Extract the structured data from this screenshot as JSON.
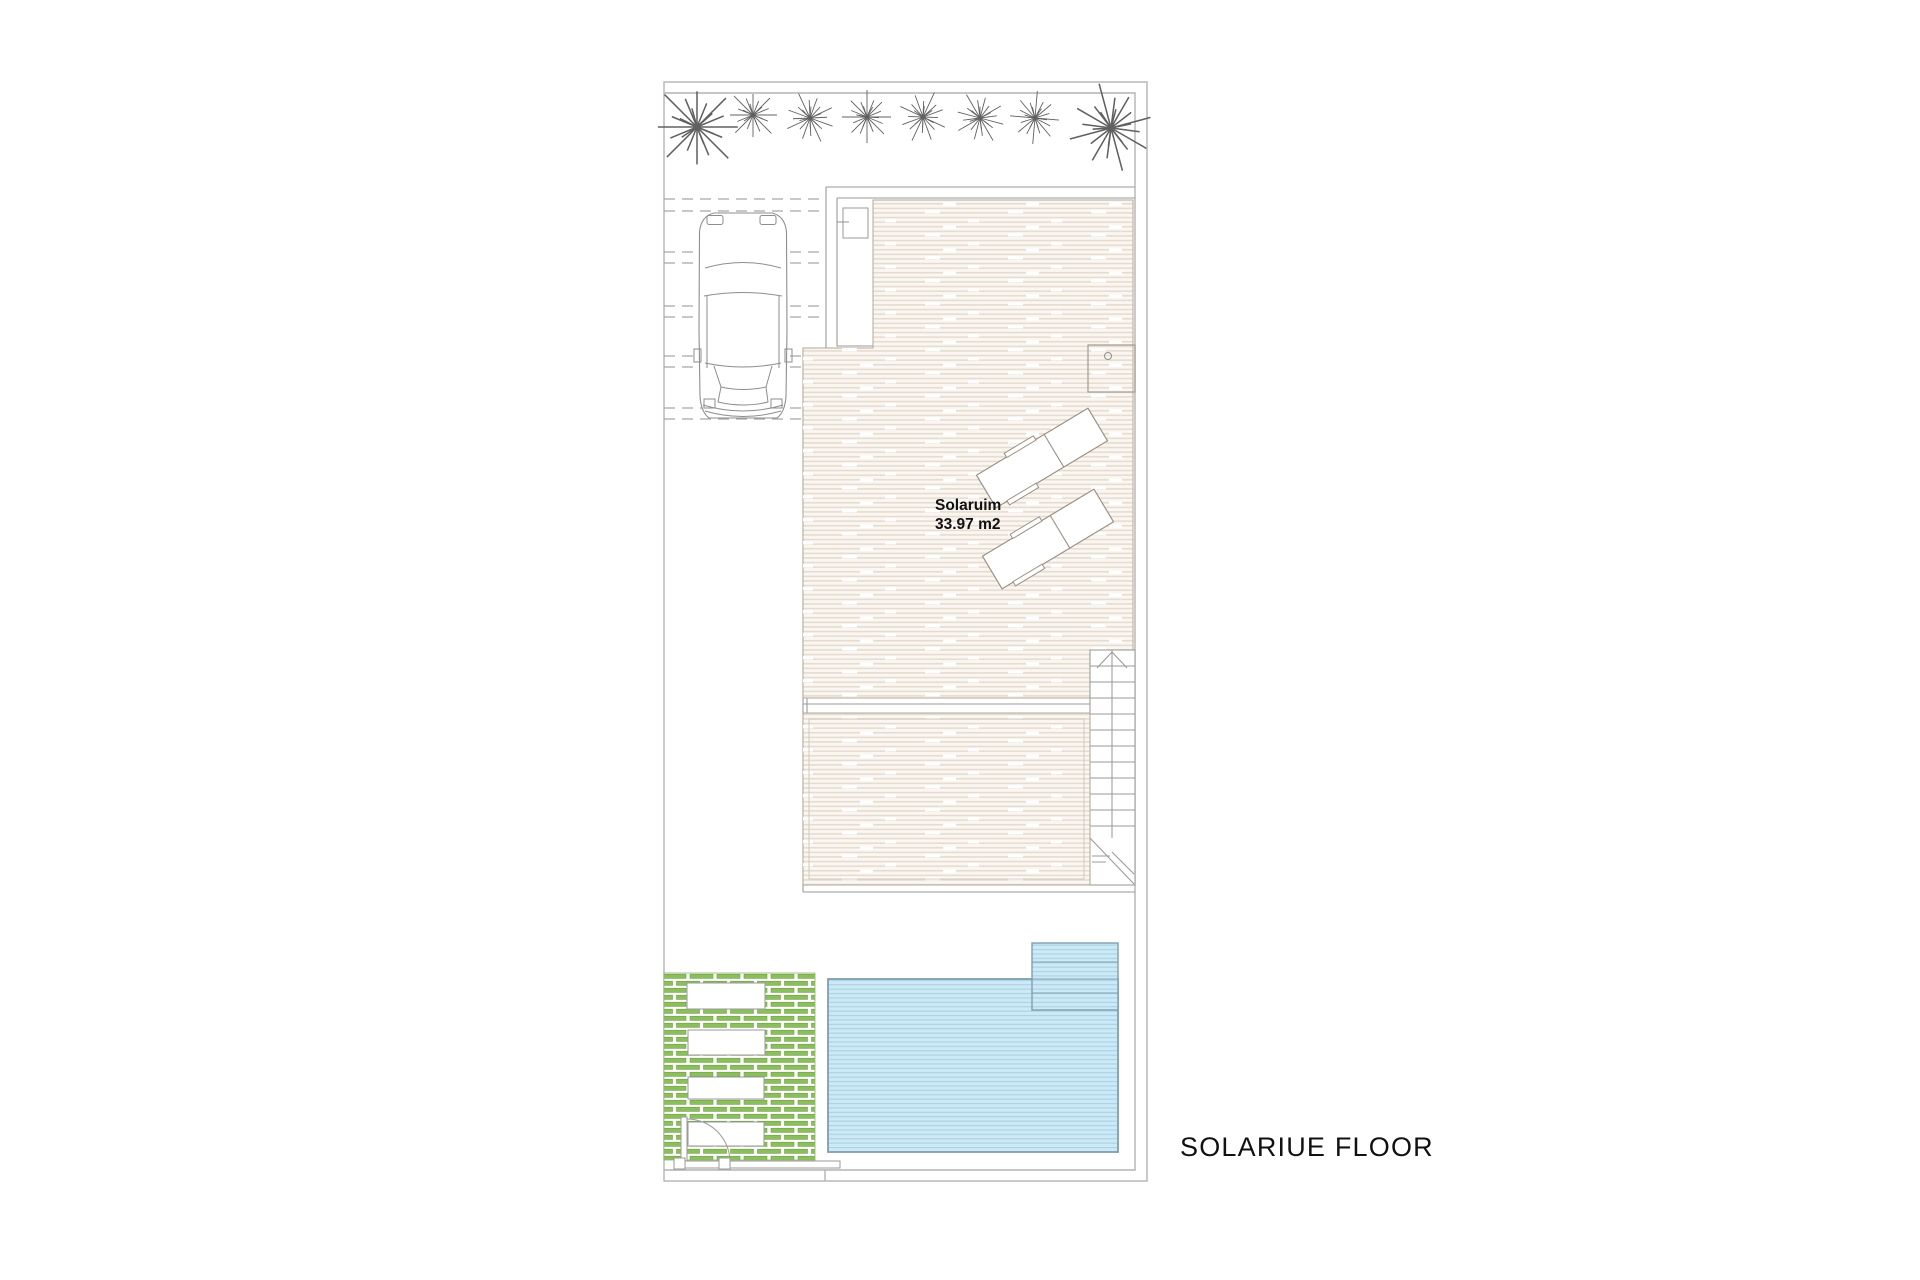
{
  "page": {
    "background": "#ffffff",
    "drawing_type": "architectural floor plan"
  },
  "title": {
    "label": "SOLARIUE FLOOR"
  },
  "solarium_label": {
    "name": "Solaruim",
    "area": "33.97 m2"
  },
  "stairs": {
    "direction": "up"
  },
  "colors": {
    "boundary_gray": "#b3b3b3",
    "wall_gray": "#9a9a9a",
    "deck_bg": "#faf7f2",
    "deck_plank": "#e5dacd",
    "deck_border": "#b2a899",
    "pool_fill": "#cde9f5",
    "pool_line": "#a6d2e6",
    "pool_border": "#7f9fae",
    "pergola_green": "#8cbe5f",
    "pergola_green_dark": "#6da23e",
    "tree_gray": "#606060",
    "text_black": "#111111"
  },
  "features": {
    "palm_trees": 8,
    "sun_loungers": 2,
    "cars": 1,
    "parking_guide_line_pairs": 5,
    "pool_steps": 4,
    "pergola_planters": 4
  }
}
